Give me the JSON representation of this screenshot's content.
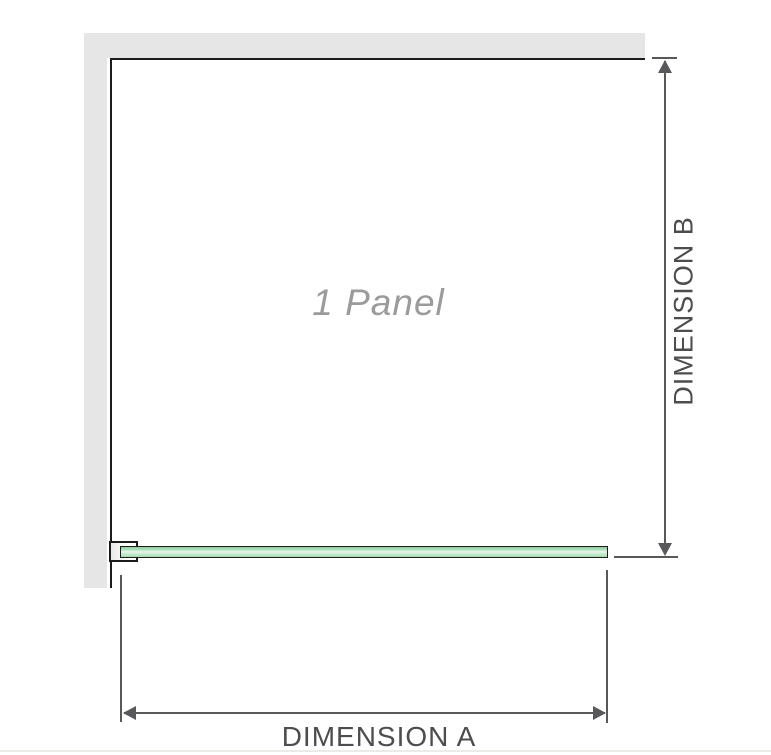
{
  "diagram": {
    "panel_label": "1 Panel",
    "dimensions": {
      "a_label": "DIMENSION A",
      "b_label": "DIMENSION B"
    }
  },
  "colors": {
    "wall_fill": "#e6e6e6",
    "panel_outline": "#1c1c1c",
    "dimension_line": "#58585a",
    "dimension_text": "#4d4d4d",
    "panel_label_text": "#9b9b9d",
    "glass_outline": "#1c1c1c",
    "glass_green_dark": "#8ecd9e",
    "glass_green_mid": "#a5dab2",
    "glass_green_light": "#e8f6eb",
    "footer_rule": "#edebe7"
  }
}
